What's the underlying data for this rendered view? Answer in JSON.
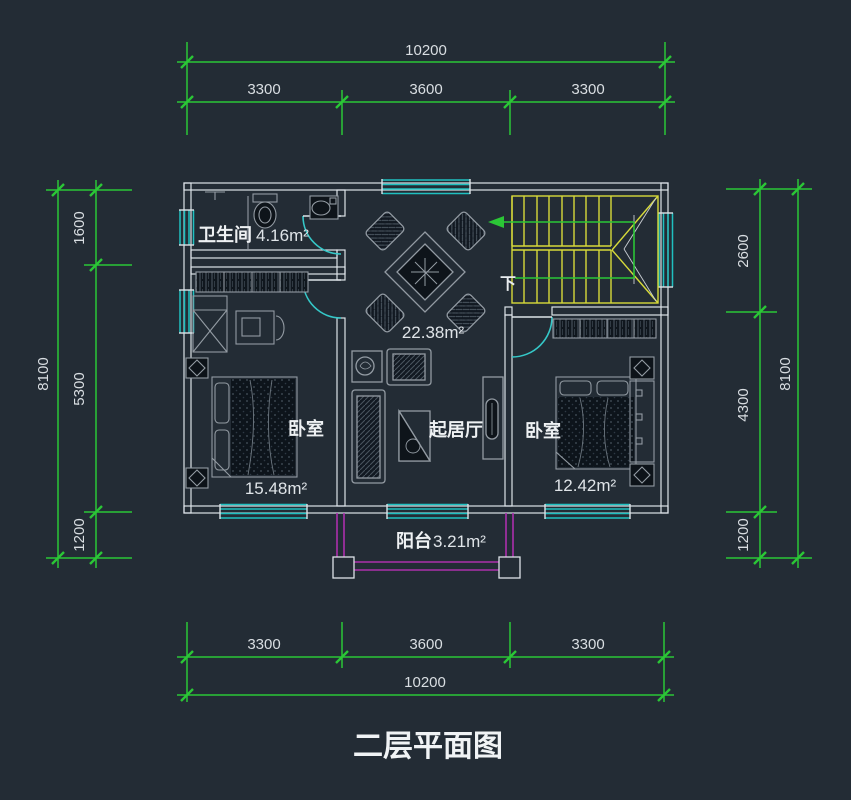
{
  "title": "二层平面图",
  "colors": {
    "background": "#232c35",
    "dimension_green": "#2bc636",
    "window_cyan": "#1fc0c0",
    "stair_yellow": "#d7da3a",
    "balcony_magenta": "#ac30ac",
    "wall_white": "#dde3e8",
    "furniture_gray": "#939ba3",
    "text_white": "#e4e8eb"
  },
  "dimensions": {
    "top": {
      "total": "10200",
      "segments": [
        "3300",
        "3600",
        "3300"
      ]
    },
    "bottom": {
      "total": "10200",
      "segments": [
        "3300",
        "3600",
        "3300"
      ]
    },
    "left": {
      "total": "8100",
      "segments": [
        "1600",
        "5300",
        "1200"
      ]
    },
    "right": {
      "total": "8100",
      "segments": [
        "2600",
        "4300",
        "1200"
      ]
    }
  },
  "rooms": {
    "bathroom": {
      "label": "卫生间",
      "area": "4.16m²"
    },
    "living": {
      "label": "起居厅",
      "area": "22.38m²"
    },
    "bedroom_left": {
      "label": "卧室",
      "area": "15.48m²"
    },
    "bedroom_right": {
      "label": "卧室",
      "area": "12.42m²"
    },
    "balcony": {
      "label": "阳台",
      "area": "3.21m²"
    }
  },
  "stairs": {
    "direction_label": "下"
  }
}
